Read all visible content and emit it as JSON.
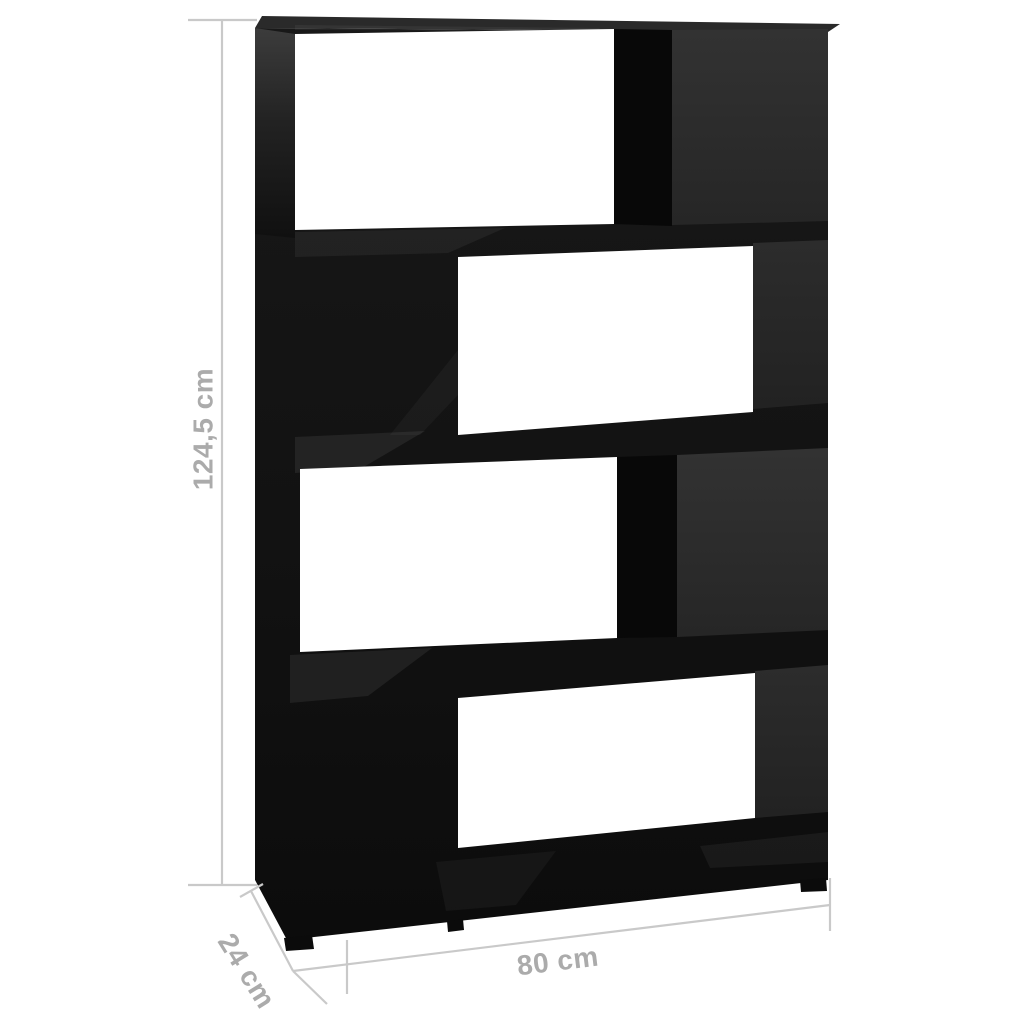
{
  "diagram": {
    "kind": "product-dimension-diagram",
    "product": "staggered-4-tier-bookcase-room-divider",
    "tier_count": 4,
    "opening_sides": [
      "left",
      "right",
      "left",
      "right"
    ]
  },
  "dimensions": {
    "height": {
      "label": "124,5 cm"
    },
    "width": {
      "label": "80 cm"
    },
    "depth": {
      "label": "24 cm"
    }
  },
  "colors": {
    "background": "#ffffff",
    "furniture_black": "#121212",
    "divider_black": "#080808",
    "panel_gray": "#2d2d2d",
    "panel_gray_dark": "#272727",
    "top_face_gray": "#2a2a2a",
    "dimension_line": "#c9c9c9",
    "dimension_text": "#ababab",
    "opening_white": "#ffffff"
  }
}
